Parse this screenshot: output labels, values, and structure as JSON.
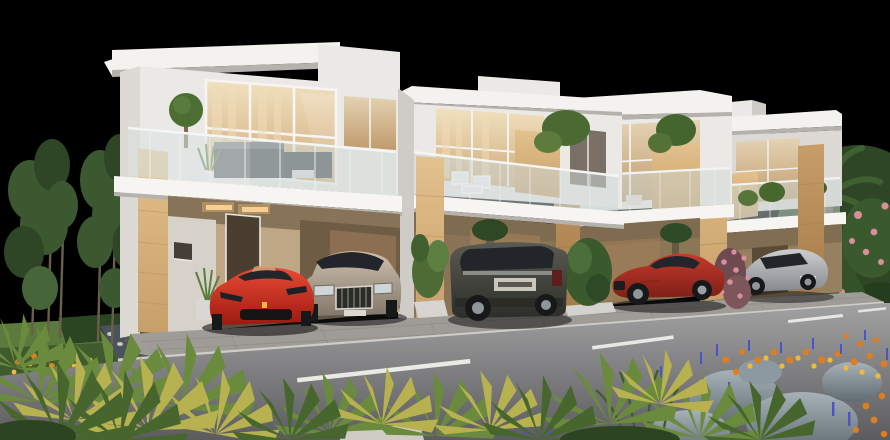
{
  "scene": {
    "title": "Modern townhouse row at dusk with luxury cars",
    "type": "3d-architectural-rendering",
    "background": "#000000",
    "house_count": 4,
    "car_count": 5
  },
  "palette": {
    "wall_white": "#ebe9e5",
    "wall_dim": "#ddd9d4",
    "wall_shadow": "#cfccc7",
    "roof_white": "#f3f2ef",
    "slab_white": "#f6f5f2",
    "fascia_shadow": "#b5b2ad",
    "stone_light": "#e3c28d",
    "stone_mid": "#c79e69",
    "stone_dark": "#a57c49",
    "glass_tint": "#cdd9d8",
    "window_warm_light": "#f0e1c0",
    "window_warm_dark": "#cfa876",
    "window_frame": "#f5f4f2",
    "window_dark": "#433f38",
    "recess_wall": "#bfa785",
    "recess_dark": "#7c6a4f",
    "carport_dark": "#6e5c45",
    "interior_warm": "#a5805a",
    "door_brown": "#4a3e31",
    "soffit_glow": "#f5c37c",
    "paver": "#9f9c97",
    "paver_dark": "#8b8883",
    "curb": "#cfcdc7",
    "asphalt_light": "#a2a2a3",
    "asphalt_dark": "#5c5c5f",
    "lane_marking": "#efefeb",
    "grass": "#5b7a3e",
    "grass_dark": "#3f5a2c",
    "hedge": "#2b4522",
    "tree_foliage": "#3c5831",
    "tree_foliage_dark": "#2e4626",
    "trunk_brown": "#6b5f4b",
    "frond_green": "#6a8a3e",
    "frond_dark": "#47662e",
    "frond_yellow": "#b7b24f",
    "flower_orange": "#df7e1e",
    "flower_yellow": "#eebb38",
    "flower_blue": "#4a55c5",
    "rose_pink": "#d98e9b",
    "rock_light": "#a7b2b8",
    "rock_dark": "#5f6a71",
    "tire": "#17181a",
    "alloy": "#8f959a",
    "car_glass": "#22262a",
    "shadow": "#141414"
  },
  "cars": [
    {
      "id": "red-sports-car",
      "label": "red sports car, front view",
      "color_light": "#ea4a35",
      "color_dark": "#9c1a10"
    },
    {
      "id": "champagne-sedan",
      "label": "champagne luxury sedan, front view",
      "color_light": "#cec0ad",
      "color_dark": "#82776a"
    },
    {
      "id": "dark-suv",
      "label": "dark grey SUV, rear three-quarter view",
      "color_light": "#5a5b53",
      "color_dark": "#2d2e29"
    },
    {
      "id": "red-coupe",
      "label": "red gullwing coupe, side view",
      "color_light": "#c63a2b",
      "color_dark": "#7e1f17"
    },
    {
      "id": "silver-coupe",
      "label": "silver coupe, rear three-quarter view",
      "color_light": "#ccced0",
      "color_dark": "#85898d"
    }
  ],
  "road": {
    "marking": "dashed center line",
    "dash_count": 4
  },
  "vegetation": {
    "left": "slender trees, lawn, hedge, orange flower bed, water rill",
    "foreground": "fan palms, ornamental grasses, granite boulders, orange and blue flowers",
    "right": "hedges, rose bushes, palm tree"
  }
}
